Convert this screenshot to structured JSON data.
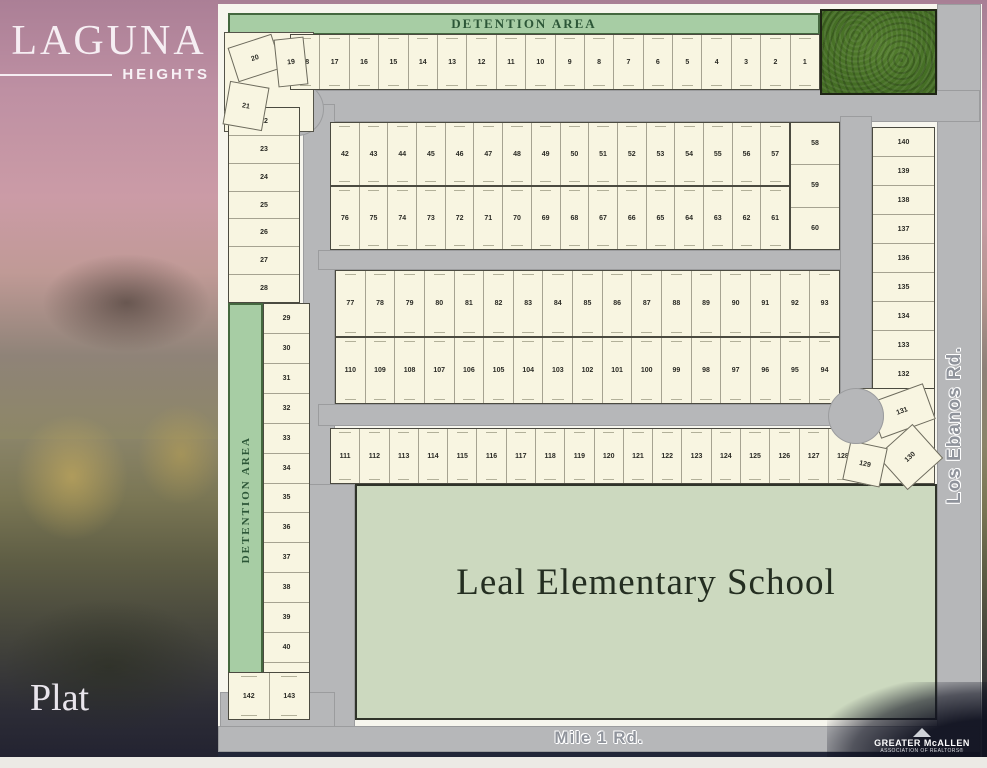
{
  "sidebar": {
    "logo_primary": "LAGUNA",
    "logo_secondary": "HEIGHTS",
    "footer_label": "Plat"
  },
  "plat": {
    "detention_top_label": "DETENTION AREA",
    "detention_left_label": "DETENTION AREA",
    "school_label": "Leal Elementary School",
    "road_bottom_label": "Mile 1 Rd.",
    "road_right_label": "Los Ebanos Rd.",
    "lot_blocks": {
      "top_row": [
        18,
        17,
        16,
        15,
        14,
        13,
        12,
        11,
        10,
        9,
        8,
        7,
        6,
        5,
        4,
        3,
        2,
        1
      ],
      "left_col_a": [
        22,
        23,
        24,
        25,
        26,
        27,
        28
      ],
      "left_col_b": [
        29,
        30,
        31,
        32,
        33,
        34,
        35,
        36,
        37,
        38,
        39,
        40,
        41
      ],
      "bottom_pair": [
        142,
        143
      ],
      "band1": [
        42,
        43,
        44,
        45,
        46,
        47,
        48,
        49,
        50,
        51,
        52,
        53,
        54,
        55,
        56,
        57
      ],
      "stack_58_60": [
        58,
        59,
        60
      ],
      "band2": [
        76,
        75,
        74,
        73,
        72,
        71,
        70,
        69,
        68,
        67,
        66,
        65,
        64,
        63,
        62,
        61
      ],
      "band3": [
        77,
        78,
        79,
        80,
        81,
        82,
        83,
        84,
        85,
        86,
        87,
        88,
        89,
        90,
        91,
        92,
        93
      ],
      "band4": [
        110,
        109,
        108,
        107,
        106,
        105,
        104,
        103,
        102,
        101,
        100,
        99,
        98,
        97,
        96,
        95,
        94
      ],
      "band5": [
        111,
        112,
        113,
        114,
        115,
        116,
        117,
        118,
        119,
        120,
        121,
        122,
        123,
        124,
        125,
        126,
        127,
        128
      ],
      "right_col": [
        140,
        139,
        138,
        137,
        136,
        135,
        134,
        133,
        132
      ]
    },
    "wedge_lots": {
      "l19": "19",
      "l20": "20",
      "l21": "21",
      "l129": "129",
      "l130": "130",
      "l131": "131"
    }
  },
  "branding": {
    "org_line1": "GREATER McALLEN",
    "org_line2": "ASSOCIATION OF REALTORS®"
  },
  "colors": {
    "road_gray": "#b6b7b9",
    "lot_cream": "#f8f5e1",
    "detention_green": "#a7cda4",
    "school_green": "#ccd9bf",
    "park_green": "#4c7929",
    "navy_strip": "#222638",
    "sidebar_pink": "#c89ba5"
  }
}
